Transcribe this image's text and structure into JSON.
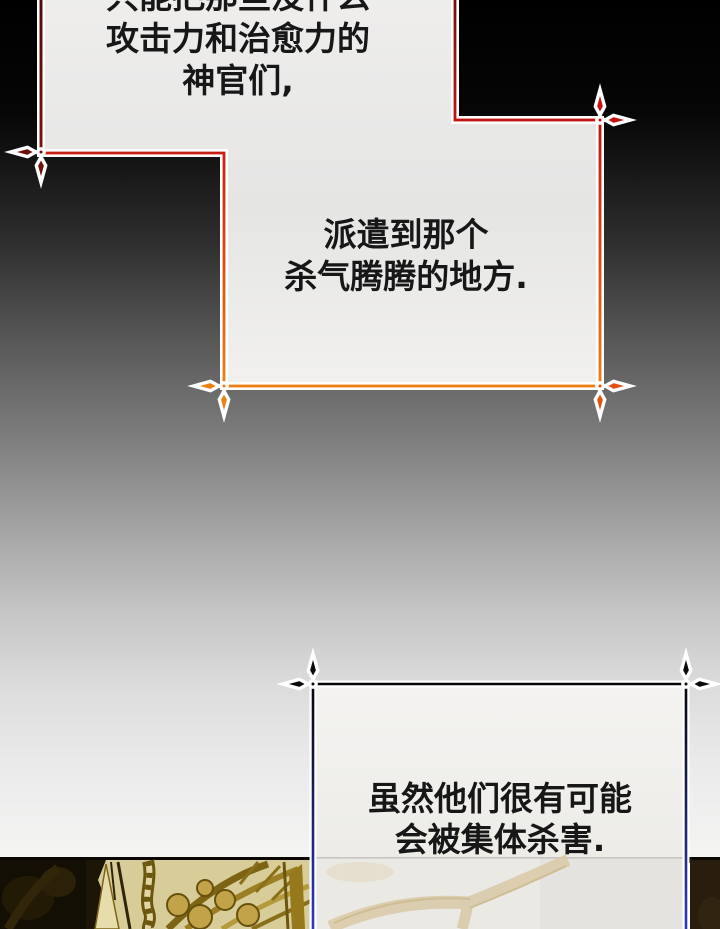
{
  "comic": {
    "narration_top": {
      "lines": [
        "只能把那些没什么",
        "攻击力和治愈力的",
        "神官们,"
      ]
    },
    "narration_mid": {
      "lines": [
        "派遣到那个",
        "杀气腾腾的地方."
      ]
    },
    "narration_bottom": {
      "lines": [
        "虽然他们很有可能",
        "会被集体杀害."
      ]
    }
  },
  "colors": {
    "text": "#171717",
    "background": {
      "top": "#000000",
      "bottom": "#f7f7f6"
    },
    "box1_border": {
      "top": "#6e100c",
      "mid": "#c31310",
      "bottom": "#f08014"
    },
    "box1_left_edge": {
      "top": "#4a0c0a",
      "bottom": "#7e130e"
    },
    "box1_fill": {
      "top": "#efeeed",
      "mid": "#e5e5e4",
      "bottom": "#f2f1ef"
    },
    "box2_border": {
      "top": "#050507",
      "mid": "#1c2260",
      "bottom": "#2e3ac8"
    },
    "box2_fill": {
      "top": "#f4f3f1",
      "bottom": "#edece7"
    },
    "ornaments": {
      "box1_left": "#6e120e",
      "box1_top_right": "#c41310",
      "box1_bottom_right": "#e4500e",
      "box1_bottom_left": "#ee7d12",
      "box2": "#0b0b0d"
    },
    "artwork": {
      "khaki_bg": "#d8cd99",
      "olive_dark": "#6b560e",
      "gold_leaf": "#c2a349",
      "panel_dark_left": "#140f04",
      "panel_dark_right": "#291e0e",
      "branch_tan": "#d9c9a6"
    }
  }
}
